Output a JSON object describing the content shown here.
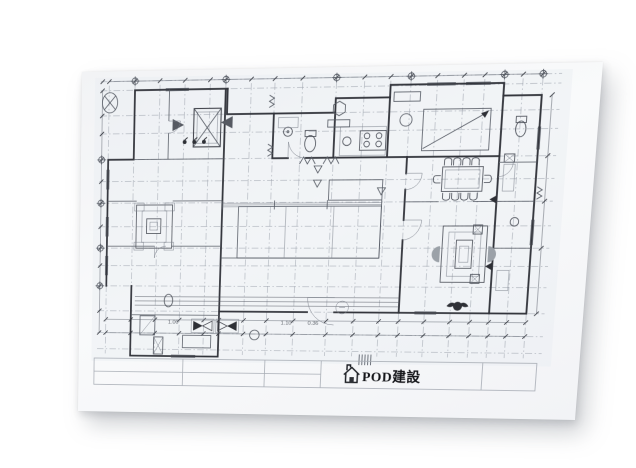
{
  "photo": {
    "background_color": "#ffffff",
    "paper_color": "#f7f8fa",
    "ink_color": "#2e3036",
    "shadow_color": "rgba(124,130,138,0.35)"
  },
  "title_block": {
    "company_name": "POD建設",
    "logo_icon": "house-icon"
  },
  "plan": {
    "type": "architectural-floor-plan",
    "dimension_labels": [
      "1.00",
      "1.10",
      "0.36"
    ]
  }
}
